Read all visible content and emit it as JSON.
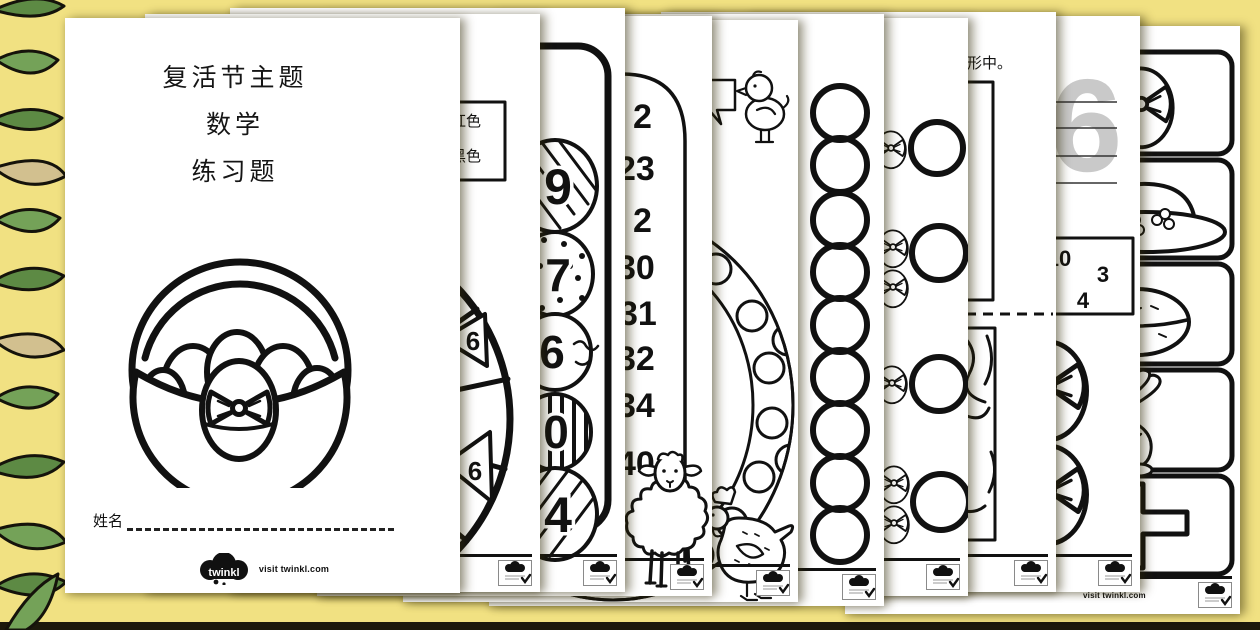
{
  "background": {
    "color": "#f1e182",
    "bottom_bar_color": "#1c190c",
    "decor": "green-leaf-border"
  },
  "brand": {
    "logo_text": "twinkl",
    "visit_text": "visit twinkl.com"
  },
  "pages": {
    "cover": {
      "title_lines": [
        "复活节主题",
        "数学",
        "练习题"
      ],
      "name_label": "姓名",
      "illustration": "easter-basket-with-eggs"
    },
    "page2": {
      "legend": [
        "红色",
        "黑色"
      ],
      "wheel_numbers": [
        "6",
        "6"
      ],
      "illustration": "number-spinner-wheel"
    },
    "page3": {
      "egg_numbers": [
        "9",
        "7",
        "6",
        "0",
        "4"
      ],
      "illustration": "patterned-number-eggs"
    },
    "page4": {
      "numbers": [
        "2",
        "23",
        "2",
        "30",
        "31",
        "32",
        "34",
        "40"
      ],
      "illustration": "lamb"
    },
    "page5": {
      "illustrations": [
        "chick-with-speech-bubble",
        "polka-dot-egg",
        "hen"
      ]
    },
    "page6": {
      "circle_count": 9
    },
    "page7": {
      "egg_groups": [
        1,
        2,
        1,
        2
      ],
      "illustration": "count-the-eggs"
    },
    "page8": {
      "instruction_fragment": "形中。",
      "illustration": "sorting-boxes"
    },
    "page9": {
      "trace_numeral": "6",
      "box_numbers": [
        "10",
        "3",
        "4"
      ],
      "illustration": "eggs-with-bows"
    },
    "page10": {
      "box_items": [
        "easter-egg-with-bow",
        "easter-bonnet",
        "hot-cross-bun",
        "easter-rabbit",
        "cross"
      ]
    }
  }
}
